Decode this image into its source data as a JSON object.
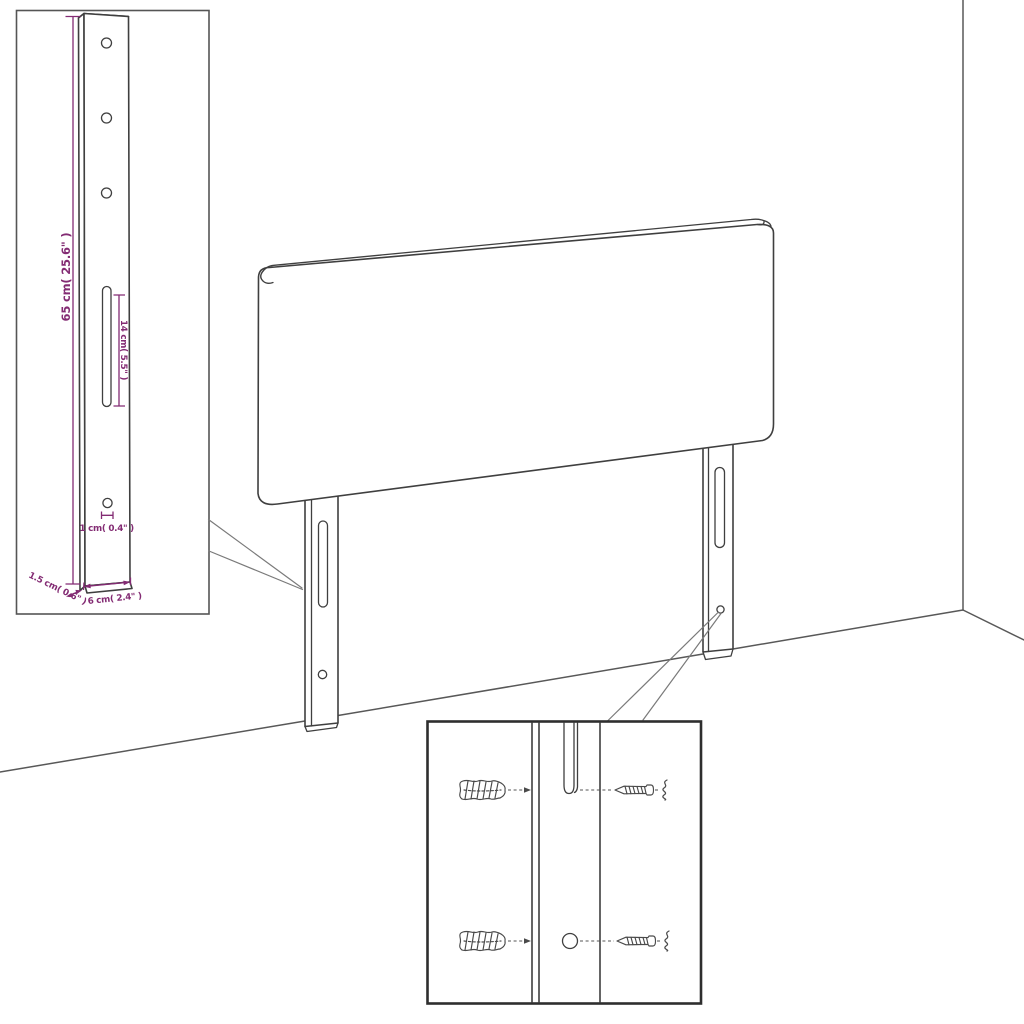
{
  "diagram": {
    "type": "furniture-assembly-dimension-diagram",
    "subject": "Headboard with two wall-mount legs in room corner",
    "background_color": "#ffffff",
    "colors": {
      "line_art": "#3f3f3f",
      "room_lines": "#585858",
      "callout_lines": "#7a7a7a",
      "dimension_text": "#832b73",
      "detail_box_border": "#2e2e2e",
      "inset_box_border": "#555555"
    },
    "inset_leg_detail": {
      "labels": {
        "leg_height": "65 cm( 25.6\" )",
        "slot_length": "14 cm( 5.5\" )",
        "hole_diameter": "1 cm( 0.4\" )",
        "leg_depth": "1.5 cm( 0.6\" )",
        "leg_width": "6 cm( 2.4\" )"
      }
    },
    "hardware_detail": {
      "icons": [
        "wall-plug-icon",
        "screw-icon",
        "wall-plug-icon",
        "screw-icon"
      ]
    }
  }
}
